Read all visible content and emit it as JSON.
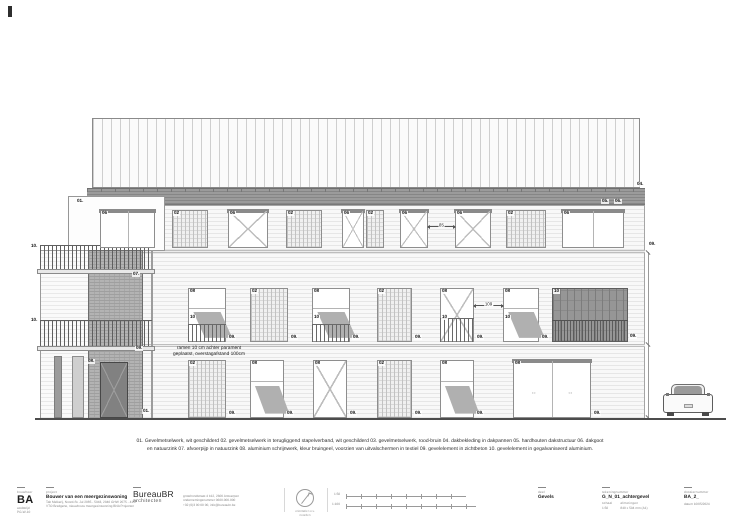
{
  "drawing": {
    "note": "ramen 10 cm achter parament geplaatst, overstagafstand 100cm",
    "windows": [
      {
        "x": 100,
        "y": 210,
        "w": 55,
        "h": 38,
        "type": "white",
        "hd": true,
        "label": "06"
      },
      {
        "x": 172,
        "y": 210,
        "w": 36,
        "h": 38,
        "type": "hatched",
        "label": "02"
      },
      {
        "x": 228,
        "y": 210,
        "w": 40,
        "h": 38,
        "type": "whitex",
        "hd": true,
        "label": "06"
      },
      {
        "x": 286,
        "y": 210,
        "w": 36,
        "h": 38,
        "type": "hatched",
        "label": "02"
      },
      {
        "x": 342,
        "y": 210,
        "w": 22,
        "h": 38,
        "type": "whitex",
        "hd": true,
        "label": "06"
      },
      {
        "x": 366,
        "y": 210,
        "w": 18,
        "h": 38,
        "type": "hatched",
        "label": "02"
      },
      {
        "x": 400,
        "y": 210,
        "w": 28,
        "h": 38,
        "type": "whitex",
        "hd": true,
        "label": "06"
      },
      {
        "x": 455,
        "y": 210,
        "w": 36,
        "h": 38,
        "type": "whitex",
        "hd": true,
        "label": "06"
      },
      {
        "x": 506,
        "y": 210,
        "w": 40,
        "h": 38,
        "type": "hatched",
        "label": "02"
      },
      {
        "x": 562,
        "y": 210,
        "w": 62,
        "h": 38,
        "type": "white",
        "hd": true,
        "label": "06"
      },
      {
        "x": 188,
        "y": 288,
        "w": 38,
        "h": 54,
        "type": "awningrail",
        "label": "08",
        "sub": "10"
      },
      {
        "x": 250,
        "y": 288,
        "w": 38,
        "h": 54,
        "type": "hatched",
        "label": "02"
      },
      {
        "x": 312,
        "y": 288,
        "w": 38,
        "h": 54,
        "type": "awningrail",
        "label": "08",
        "sub": "10"
      },
      {
        "x": 377,
        "y": 288,
        "w": 35,
        "h": 54,
        "type": "hatched",
        "label": "02"
      },
      {
        "x": 440,
        "y": 288,
        "w": 34,
        "h": 54,
        "type": "railx",
        "label": "08",
        "sub": "10"
      },
      {
        "x": 503,
        "y": 288,
        "w": 36,
        "h": 54,
        "type": "awning",
        "label": "08",
        "sub": "10"
      },
      {
        "x": 552,
        "y": 288,
        "w": 76,
        "h": 54,
        "type": "dark",
        "label": "10"
      },
      {
        "x": 188,
        "y": 360,
        "w": 38,
        "h": 58,
        "type": "hatched",
        "label": "02"
      },
      {
        "x": 250,
        "y": 360,
        "w": 34,
        "h": 58,
        "type": "awning",
        "label": "08"
      },
      {
        "x": 313,
        "y": 360,
        "w": 34,
        "h": 58,
        "type": "doorx",
        "label": "08"
      },
      {
        "x": 377,
        "y": 360,
        "w": 35,
        "h": 58,
        "type": "hatched",
        "label": "02"
      },
      {
        "x": 440,
        "y": 360,
        "w": 34,
        "h": 58,
        "type": "awning",
        "label": "08"
      },
      {
        "x": 513,
        "y": 360,
        "w": 78,
        "h": 58,
        "type": "sliding",
        "hd": true,
        "label": "08"
      }
    ],
    "labels": [
      {
        "t": "01.",
        "x": 76,
        "y": 199
      },
      {
        "t": "10.",
        "x": 30,
        "y": 244
      },
      {
        "t": "07.",
        "x": 132,
        "y": 272
      },
      {
        "t": "10.",
        "x": 30,
        "y": 318
      },
      {
        "t": "09.",
        "x": 135,
        "y": 346
      },
      {
        "t": "08.",
        "x": 87,
        "y": 359
      },
      {
        "t": "01.",
        "x": 142,
        "y": 409
      },
      {
        "t": "04.",
        "x": 636,
        "y": 182
      },
      {
        "t": "05.",
        "x": 601,
        "y": 199
      },
      {
        "t": "06.",
        "x": 614,
        "y": 199
      },
      {
        "t": "09.",
        "x": 648,
        "y": 242
      },
      {
        "t": "09.",
        "x": 629,
        "y": 334
      },
      {
        "t": "09.",
        "x": 228,
        "y": 335
      },
      {
        "t": "09.",
        "x": 290,
        "y": 335
      },
      {
        "t": "09.",
        "x": 352,
        "y": 335
      },
      {
        "t": "09.",
        "x": 414,
        "y": 335
      },
      {
        "t": "09.",
        "x": 476,
        "y": 335
      },
      {
        "t": "09.",
        "x": 541,
        "y": 335
      },
      {
        "t": "09.",
        "x": 228,
        "y": 411
      },
      {
        "t": "09.",
        "x": 286,
        "y": 411
      },
      {
        "t": "09.",
        "x": 349,
        "y": 411
      },
      {
        "t": "09.",
        "x": 414,
        "y": 411
      },
      {
        "t": "09.",
        "x": 476,
        "y": 411
      },
      {
        "t": "09.",
        "x": 593,
        "y": 411
      }
    ],
    "dims": [
      {
        "label": "85",
        "x1": 428,
        "x2": 455,
        "y": 226
      },
      {
        "label": "109",
        "x1": 474,
        "x2": 503,
        "y": 305
      }
    ]
  },
  "legend": {
    "line1": "01. Gevelmetselwerk, wit geschilderd  02. gevelmetselwerk in terugliggend stapelverband, wit geschilderd   03. gevelmetselwerk, rood-bruin  04. dakbekleding in dakpannen  05. hardhouten dakstructuur  06. dakgoot",
    "line2": "en natuurzink  07. afvoerpijp in natuurzink  08. aluminium schrijnwerk, kleur bruingeel, voorzien van uitvalschermen in textiel   09. gevelelement in zichtbeton  10. gevelelement in gegalvaniseerd aluminium."
  },
  "titleblock": {
    "logo_header": "bouwheer",
    "logo": "BA",
    "logo_sub1": "wedstrijd",
    "logo_sub2": "PG-W-10",
    "project_header": "project",
    "project_title": "Bouwer van een meergezinswoning",
    "project_sub1": "Tab Melkerij, Noord-St. Jul 2085 - 5943, 2040 GHW 2075 - 4157",
    "project_sub2": "VTO Bredgene, nieuwbouw meergezinswoning BNA Projecten",
    "architect_name": "BureauBR",
    "architect_sub": "architecten",
    "architect_info1": "grotehondstraat 4 b12, 2600 Antwerpen",
    "architect_info2": "ondernemingsnummer 0600.000.000",
    "architect_info3": "+32 (0)3 00 00 00, info@bureaubr.be",
    "north_cap1": "orientatie t.o.v.",
    "north_cap2": "noorden",
    "scale1": "1:50",
    "scale2": "1:100",
    "part_header": "deel",
    "part": "Gevels",
    "drawing_header": "tekeningnummer",
    "drawing_number": "G_N_01_achtergevel",
    "scale_label": "schaal",
    "scale_value": "1:50",
    "format_label": "afmetingen",
    "format_value": "840 x 594 mm (A1)",
    "dossier_header": "dossiernummer",
    "dossier": "BA_2_",
    "date": "datum 10/05/2024"
  }
}
